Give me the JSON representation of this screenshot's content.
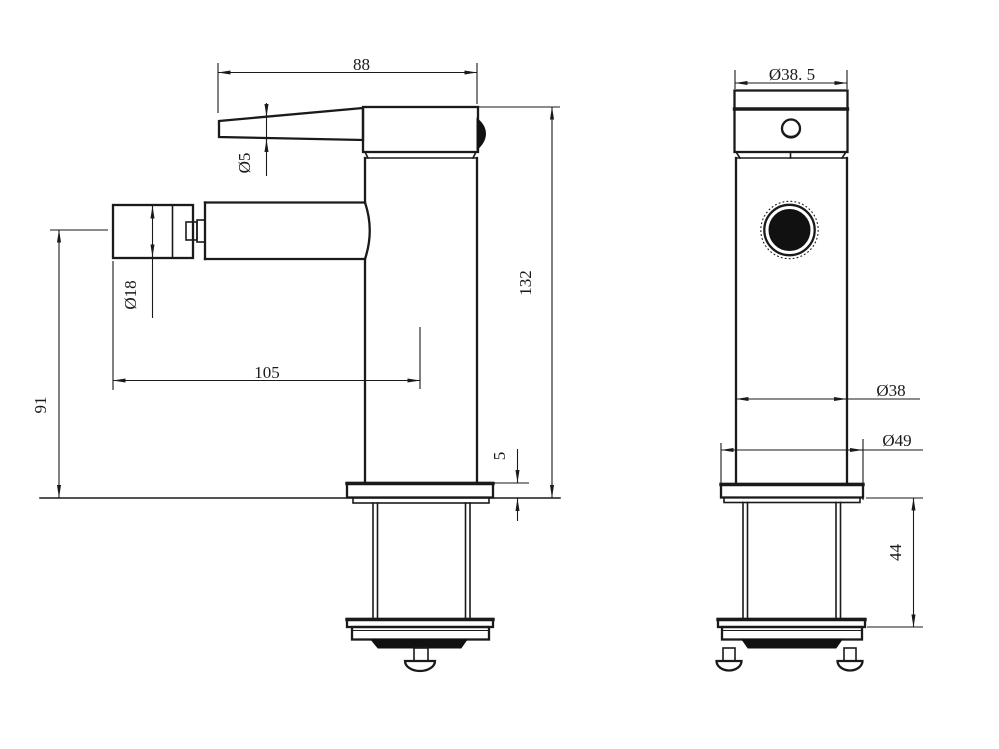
{
  "colors": {
    "line": "#1a1a1a",
    "background": "#ffffff",
    "dark_fill": "#111111"
  },
  "dims": {
    "handle_span": "88",
    "lever_diameter": "Ø5",
    "spout_diameter": "Ø18",
    "spout_reach": "105",
    "spout_height": "91",
    "total_height": "132",
    "flange_thickness": "5",
    "cap_diameter": "Ø38. 5",
    "body_diameter": "Ø38",
    "flange_diameter": "Ø49",
    "shank_height": "44"
  }
}
